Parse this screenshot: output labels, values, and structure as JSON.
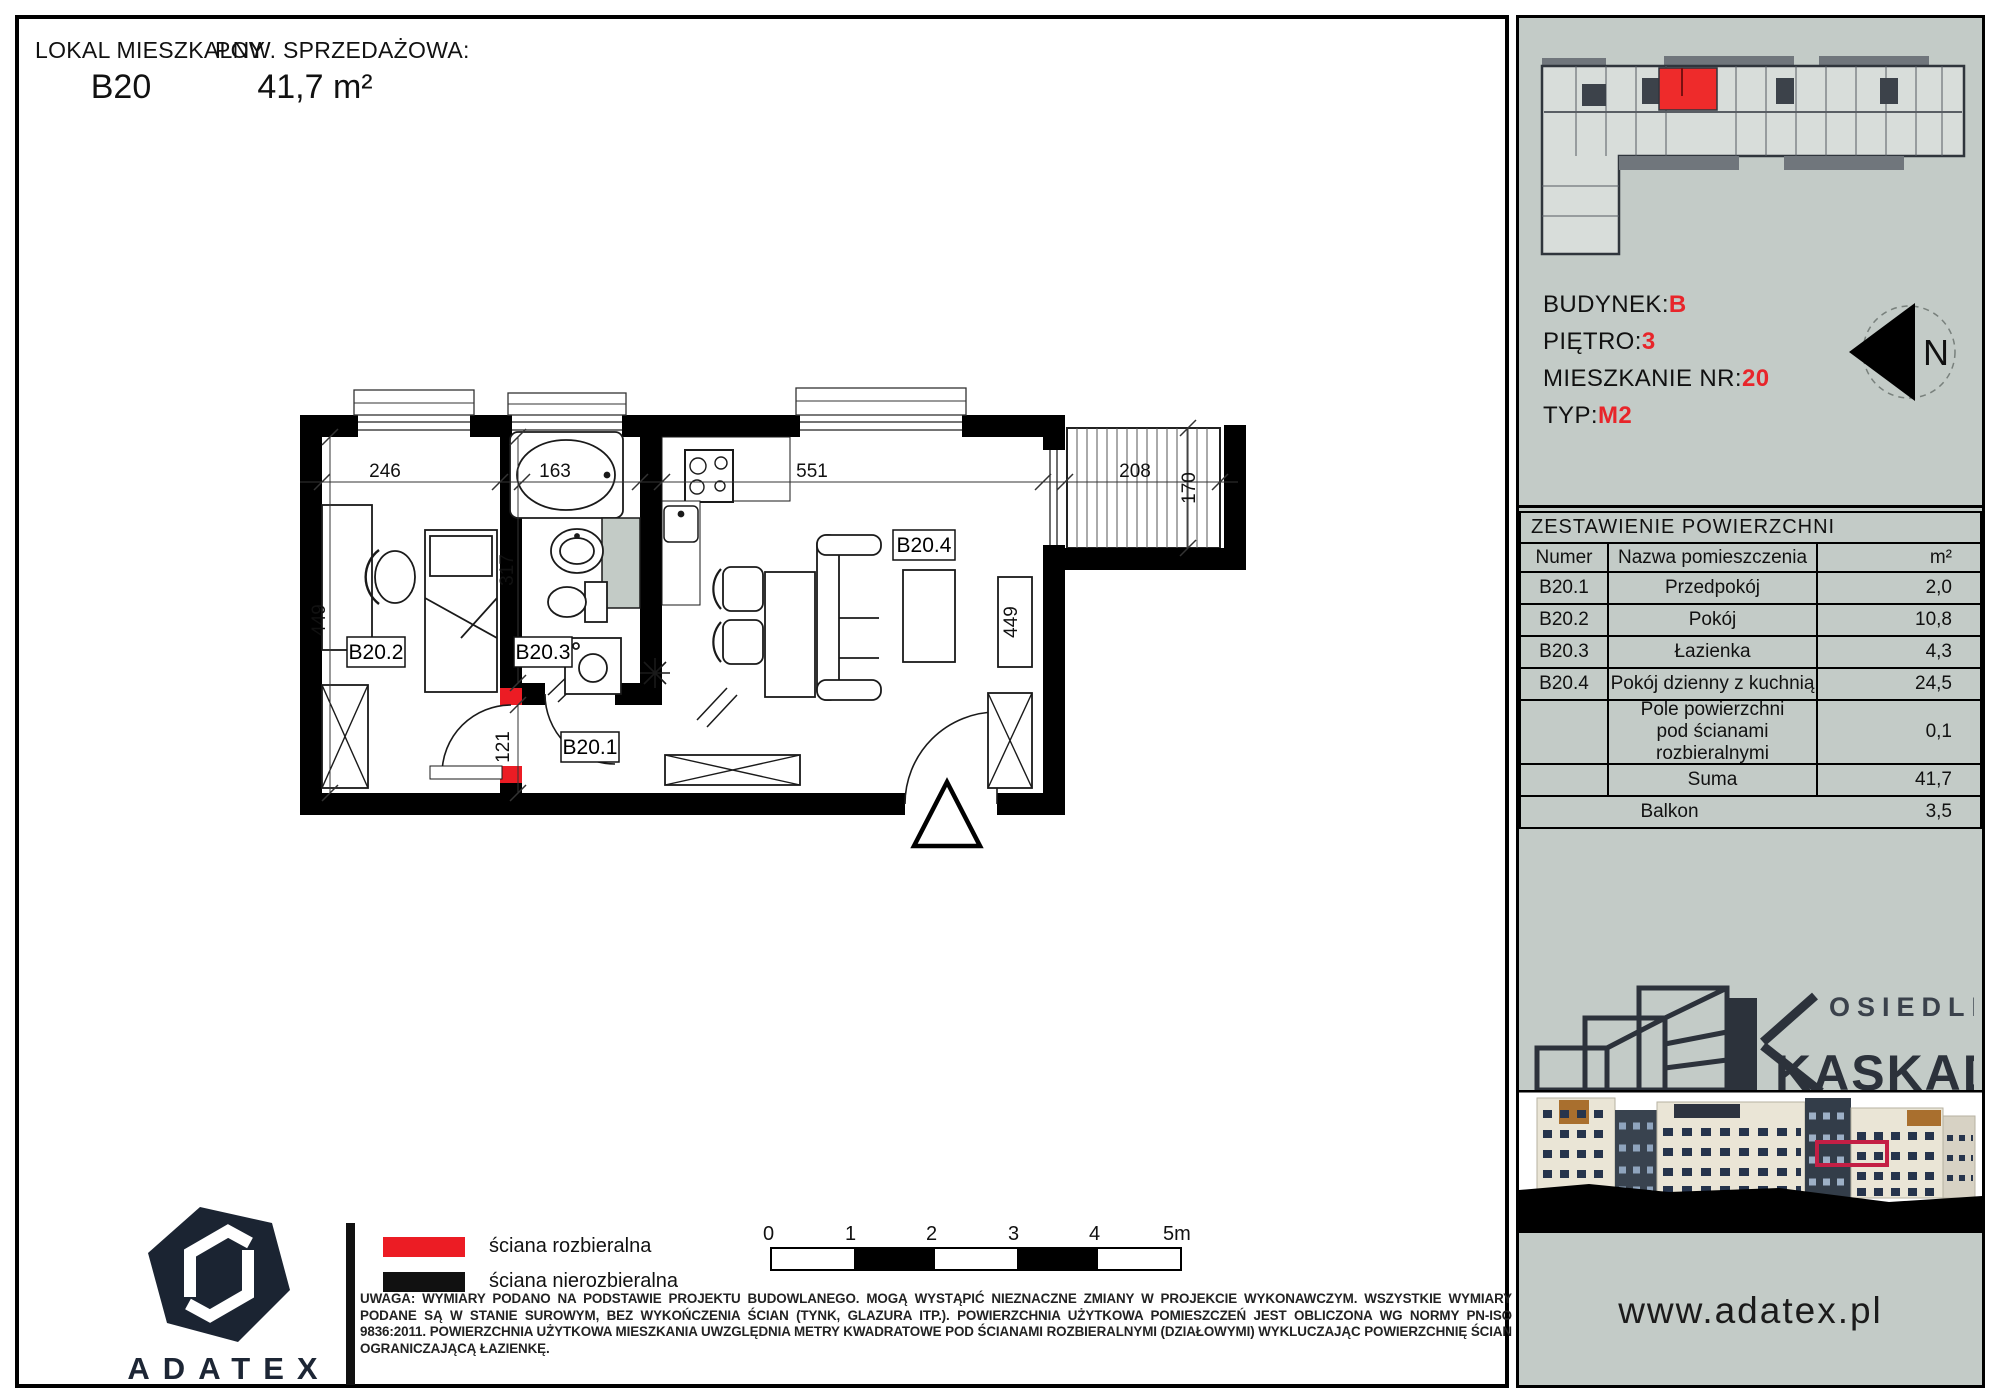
{
  "header": {
    "unit_label": "LOKAL MIESZKALNY",
    "unit_value": "B20",
    "area_label": "POW. SPRZEDAŻOWA:",
    "area_value": "41,7 m²"
  },
  "plan": {
    "labels": {
      "hall": "B20.1",
      "room": "B20.2",
      "bath": "B20.3",
      "living": "B20.4"
    },
    "dims": {
      "room_w": "246",
      "bath_w": "163",
      "living_w": "551",
      "balcony_w": "208",
      "room_h": "449",
      "bath_h": "317",
      "hall_h": "121",
      "living_h": "449",
      "balcony_h": "170"
    }
  },
  "sidebar": {
    "info": {
      "rows": [
        {
          "label": "BUDYNEK:",
          "value": "B"
        },
        {
          "label": "PIĘTRO:",
          "value": "3"
        },
        {
          "label": "MIESZKANIE NR:",
          "value": "20"
        },
        {
          "label": "TYP:",
          "value": "M2"
        }
      ],
      "north": "N"
    },
    "table": {
      "title": "ZESTAWIENIE POWIERZCHNI",
      "columns": {
        "num": "Numer",
        "name": "Nazwa pomieszczenia",
        "area": "m²"
      },
      "rows": [
        {
          "num": "B20.1",
          "name": "Przedpokój",
          "area": "2,0"
        },
        {
          "num": "B20.2",
          "name": "Pokój",
          "area": "10,8"
        },
        {
          "num": "B20.3",
          "name": "Łazienka",
          "area": "4,3"
        },
        {
          "num": "B20.4",
          "name": "Pokój dzienny z kuchnią",
          "area": "24,5"
        }
      ],
      "wall_row": {
        "name": "Pole powierzchni pod ścianami rozbieralnymi",
        "area": "0,1"
      },
      "suma_row": {
        "name": "Suma",
        "area": "41,7"
      },
      "balkon_row": {
        "name": "Balkon",
        "area": "3,5"
      }
    },
    "brand": {
      "line1": "OSIEDLE",
      "line2": "KASKADA"
    },
    "website": "www.adatex.pl"
  },
  "legend": {
    "removable": "ściana rozbieralna",
    "fixed": "ściana nierozbieralna"
  },
  "scale": {
    "labels": [
      "0",
      "1",
      "2",
      "3",
      "4",
      "5m"
    ]
  },
  "note": "UWAGA: WYMIARY PODANO NA PODSTAWIE PROJEKTU BUDOWLANEGO. MOGĄ WYSTĄPIĆ NIEZNACZNE ZMIANY W PROJEKCIE WYKONAWCZYM. WSZYSTKIE WYMIARY PODANE SĄ W STANIE SUROWYM, BEZ WYKOŃCZENIA ŚCIAN (TYNK, GLAZURA ITP.). POWIERZCHNIA UŻYTKOWA POMIESZCZEŃ JEST OBLICZONA WG NORMY PN-ISO 9836:2011. POWIERZCHNIA UŻYTKOWA MIESZKANIA UWZGLĘDNIA METRY KWADRATOWE POD ŚCIANAMI ROZBIERALNYMI (DZIAŁOWYMI) WYKLUCZAJĄC POWIERZCHNIĘ ŚCIAN OGRANICZAJĄCĄ ŁAZIENKĘ.",
  "developer": "ADATEX",
  "colors": {
    "accent": "#ec1c24",
    "sidebar_bg": "#c3cbc7",
    "wall": "#000000"
  }
}
